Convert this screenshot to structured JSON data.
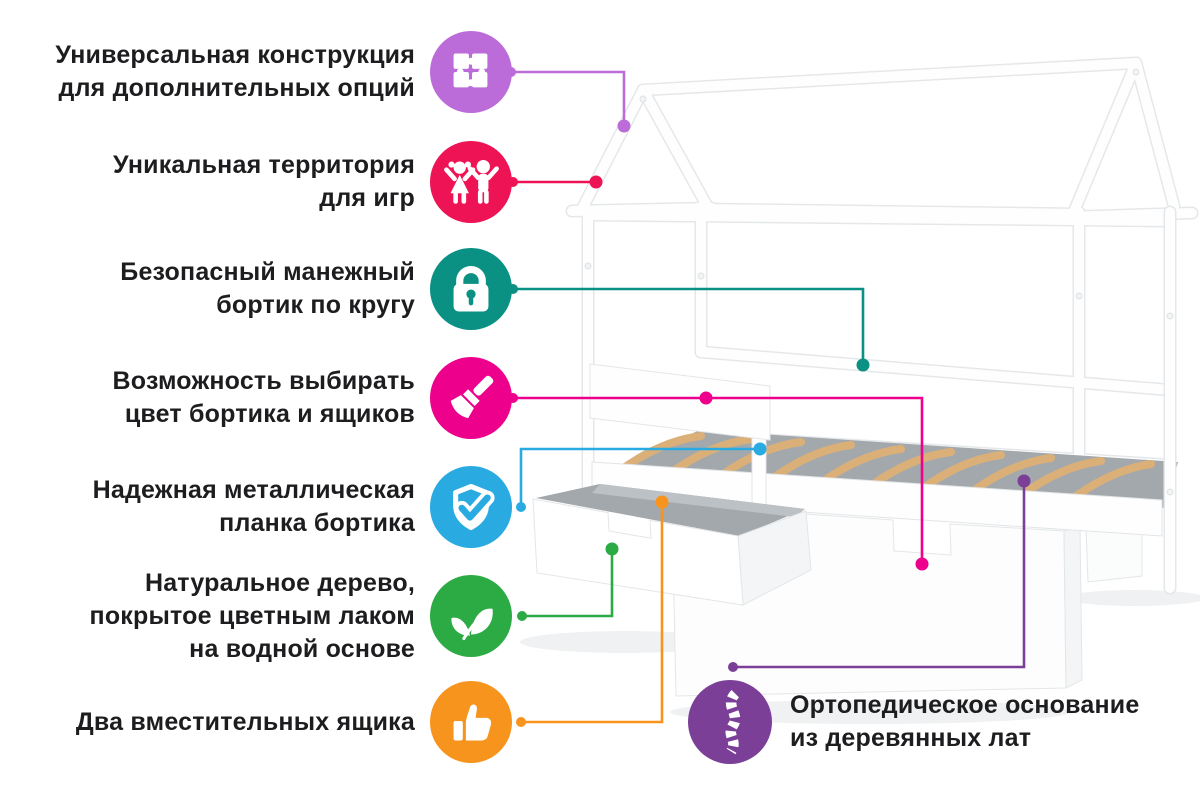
{
  "page": {
    "background_color": "#ffffff",
    "text_color": "#1d1d1f",
    "language": "ru"
  },
  "features": [
    {
      "id": "universal-construction",
      "icon": "puzzle-icon",
      "color": "#bb6cd8",
      "lines": [
        "Универсальная конструкция",
        "для дополнительных опций"
      ]
    },
    {
      "id": "play-territory",
      "icon": "children-icon",
      "color": "#ee1354",
      "lines": [
        "Уникальная территория",
        "для игр"
      ]
    },
    {
      "id": "safety-rail",
      "icon": "lock-icon",
      "color": "#0a9183",
      "lines": [
        "Безопасный манежный",
        "бортик по кругу"
      ]
    },
    {
      "id": "color-choice",
      "icon": "paintbrush-icon",
      "color": "#ec008c",
      "lines": [
        "Возможность выбирать",
        "цвет бортика и ящиков"
      ]
    },
    {
      "id": "metal-plank",
      "icon": "shield-check-icon",
      "color": "#29abe2",
      "lines": [
        "Надежная металлическая",
        "планка бортика"
      ]
    },
    {
      "id": "natural-wood",
      "icon": "leaf-icon",
      "color": "#2cab45",
      "lines": [
        "Натуральное дерево,",
        "покрытое цветным лаком",
        "на водной основе"
      ]
    },
    {
      "id": "two-drawers",
      "icon": "thumbs-up-icon",
      "color": "#f7941d",
      "lines": [
        "Два вместительных ящика"
      ]
    },
    {
      "id": "orthopedic-base",
      "icon": "spine-icon",
      "color": "#7b3f98",
      "lines": [
        "Ортопедическое основание",
        "из деревянных лат"
      ]
    }
  ],
  "illustration": {
    "subject": "white house-frame children's bed with slatted base and two storage drawers",
    "frame_color": "#fefefe",
    "outline_color": "#e5e8ea",
    "slats_color": "#dbb078",
    "interior_color": "#a3a8ac",
    "shadow_color": "#eff1f2"
  }
}
